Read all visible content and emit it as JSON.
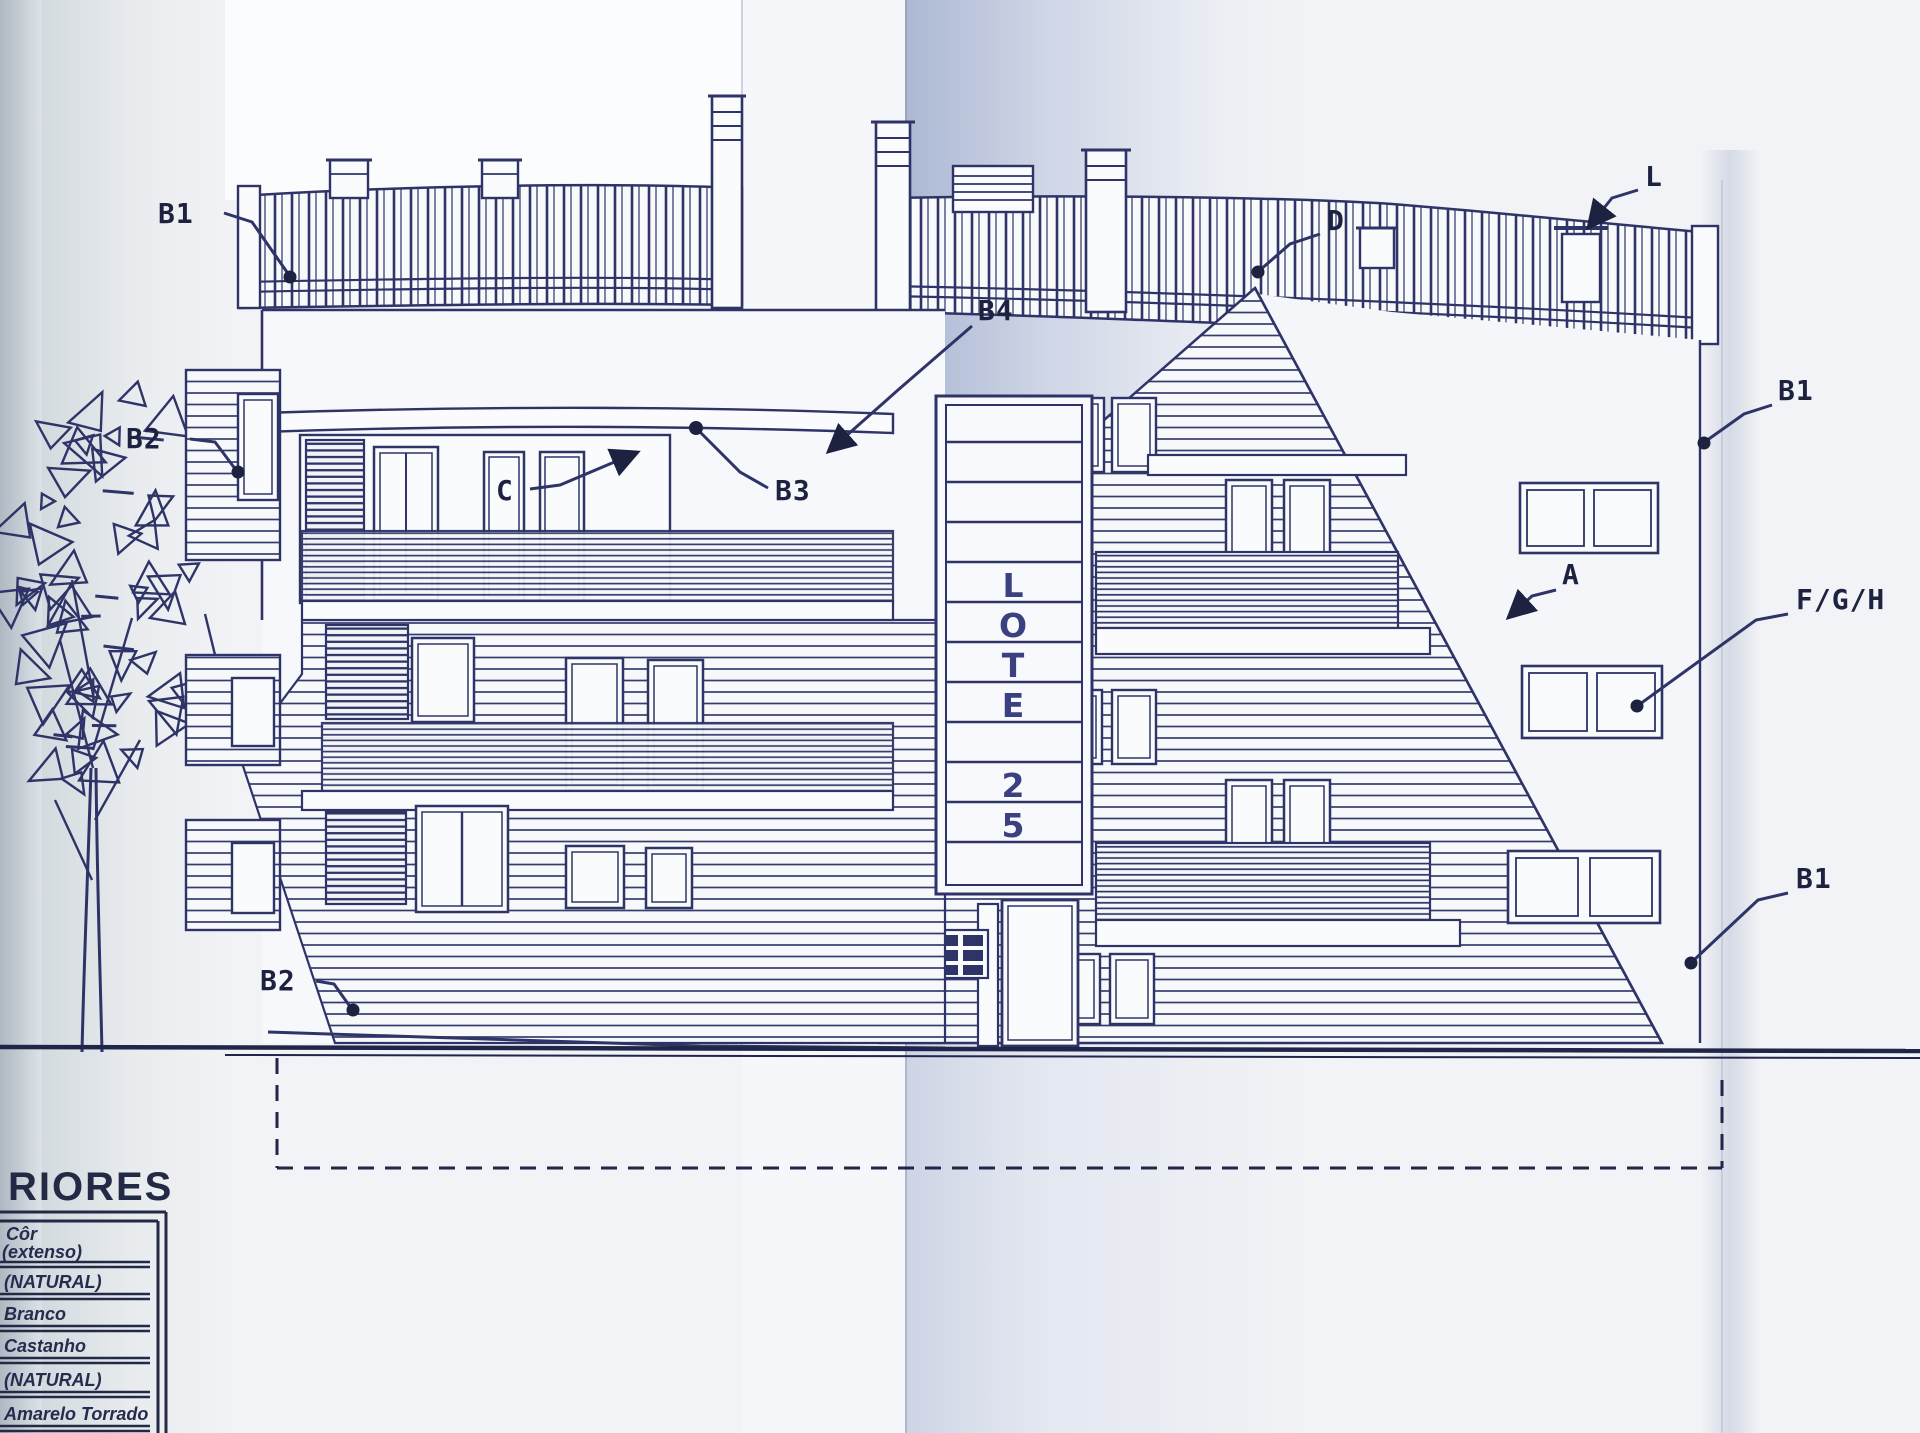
{
  "title": "Building elevation blueprint - LOTE 25",
  "sign": {
    "letters": [
      "L",
      "O",
      "T",
      "E",
      "2",
      "5"
    ]
  },
  "callouts": {
    "b1_top_left": "B1",
    "b2_left": "B2",
    "c": "C",
    "b3": "B3",
    "b4": "B4",
    "d": "D",
    "l": "L",
    "b1_right": "B1",
    "a": "A",
    "fgh": "F/G/H",
    "b1_bottom_right": "B1",
    "b2_bottom": "B2"
  },
  "legend": {
    "title_fragment": "RIORES",
    "header_line1": "Côr",
    "header_line2": "(extenso)",
    "rows": [
      "(NATURAL)",
      "Branco",
      "Castanho",
      "(NATURAL)",
      "Amarelo Torrado"
    ]
  },
  "colors": {
    "ink": "#2e3467",
    "paper": "#f3f4f6",
    "fold_tint": "#c3cde2",
    "scan_edge": "#b8c2ca"
  }
}
